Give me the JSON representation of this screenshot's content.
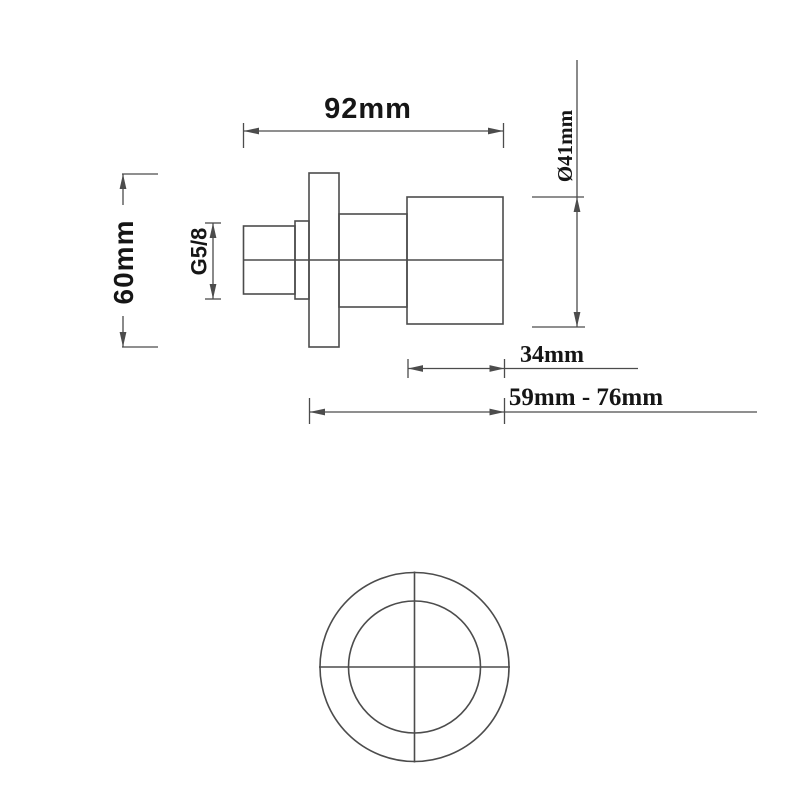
{
  "drawing": {
    "title": "valve-dimension-drawing",
    "views": {
      "side_view": "side-profile-with-dimensions",
      "front_view": "concentric-circles-with-crosshair"
    },
    "labels": {
      "overall_width": "92mm",
      "flange_height": "60mm",
      "thread_size": "G5/8",
      "handle_diameter": "Ø41mm",
      "handle_length": "34mm",
      "depth_range": "59mm - 76mm"
    },
    "colors": {
      "background": "#ffffff",
      "line": "#4c4c4c",
      "text": "#161616"
    }
  }
}
